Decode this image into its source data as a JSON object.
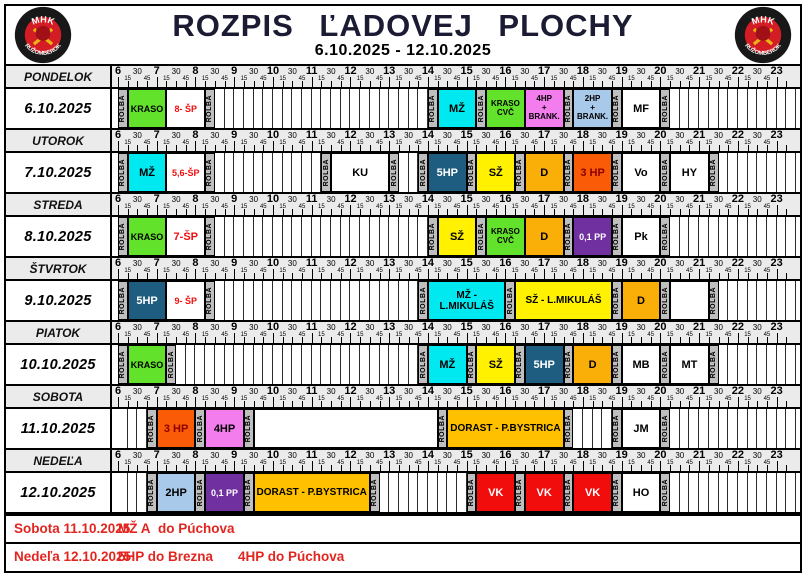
{
  "header": {
    "title": "ROZPIS ĽADOVEJ PLOCHY",
    "date_range": "6.10.2025 - 12.10.2025",
    "logo_top": "MHK",
    "logo_bottom": "RUŽOMBEROK"
  },
  "timeline": {
    "start": "6:00",
    "end": "23:30",
    "hours": [
      6,
      7,
      8,
      9,
      10,
      11,
      12,
      13,
      14,
      15,
      16,
      17,
      18,
      19,
      20,
      21,
      22,
      23
    ],
    "minute_labels": [
      "15",
      "30",
      "45"
    ]
  },
  "colors": {
    "rolba_bg": "#BFBFBF",
    "scale_bg": "#EBEBEB",
    "kraso_green": "#62E22B",
    "cyan": "#00E9F0",
    "yellow": "#FFF100",
    "dark_blue": "#1E5C80",
    "orange": "#FAAE08",
    "amber": "#FFC000",
    "orange_red": "#F95B06",
    "pink": "#F47DEE",
    "light_blue": "#A9C9EA",
    "purple": "#7030A0",
    "red": "#F20D0D",
    "sp_text_red": "#F10E0E",
    "dark_red_text": "#8B0000",
    "footer_red": "#E2251F",
    "title_color": "#1B1B33"
  },
  "days": [
    {
      "name": "PONDELOK",
      "date": "6.10.2025",
      "blocks": [
        {
          "s": "6:00",
          "e": "6:15",
          "l": "ROLBA",
          "t": "rolba"
        },
        {
          "s": "6:15",
          "e": "7:15",
          "l": "KRASO",
          "bg": "#62E22B",
          "fg": "#000000"
        },
        {
          "s": "7:15",
          "e": "8:15",
          "l": "8- ŠP",
          "bg": "#FFFFFF",
          "fg": "#F10E0E"
        },
        {
          "s": "8:15",
          "e": "8:30",
          "l": "ROLBA",
          "t": "rolba"
        },
        {
          "s": "14:00",
          "e": "14:15",
          "l": "ROLBA",
          "t": "rolba"
        },
        {
          "s": "14:15",
          "e": "15:15",
          "l": "MŽ",
          "bg": "#00E9F0",
          "fg": "#000000"
        },
        {
          "s": "15:15",
          "e": "15:30",
          "l": "ROLBA",
          "t": "rolba"
        },
        {
          "s": "15:30",
          "e": "16:30",
          "l": "KRASO\nCVČ",
          "bg": "#62E22B",
          "fg": "#000000"
        },
        {
          "s": "16:30",
          "e": "17:30",
          "l": "4HP\n+\nBRANK.",
          "bg": "#F47DEE",
          "fg": "#000000"
        },
        {
          "s": "17:30",
          "e": "17:45",
          "l": "ROLBA",
          "t": "rolba"
        },
        {
          "s": "17:45",
          "e": "18:45",
          "l": "2HP\n+ BRANK.",
          "bg": "#A9C9EA",
          "fg": "#000000"
        },
        {
          "s": "18:45",
          "e": "19:00",
          "l": "ROLBA",
          "t": "rolba"
        },
        {
          "s": "19:00",
          "e": "20:00",
          "l": "MF",
          "bg": "#FFFFFF",
          "fg": "#000000"
        },
        {
          "s": "20:00",
          "e": "20:15",
          "l": "ROLBA",
          "t": "rolba"
        }
      ]
    },
    {
      "name": "UTOROK",
      "date": "7.10.2025",
      "blocks": [
        {
          "s": "6:00",
          "e": "6:15",
          "l": "ROLBA",
          "t": "rolba"
        },
        {
          "s": "6:15",
          "e": "7:15",
          "l": "MŽ",
          "bg": "#00E9F0",
          "fg": "#000000"
        },
        {
          "s": "7:15",
          "e": "8:15",
          "l": "5,6-ŠP",
          "bg": "#FFFFFF",
          "fg": "#F10E0E"
        },
        {
          "s": "8:15",
          "e": "8:30",
          "l": "ROLBA",
          "t": "rolba"
        },
        {
          "s": "11:15",
          "e": "11:30",
          "l": "ROLBA",
          "t": "rolba"
        },
        {
          "s": "11:30",
          "e": "13:00",
          "l": "KU",
          "bg": "#FFFFFF",
          "fg": "#000000"
        },
        {
          "s": "13:00",
          "e": "13:15",
          "l": "ROLBA",
          "t": "rolba"
        },
        {
          "s": "13:45",
          "e": "14:00",
          "l": "ROLBA",
          "t": "rolba"
        },
        {
          "s": "14:00",
          "e": "15:00",
          "l": "5HP",
          "bg": "#1E5C80",
          "fg": "#FFFFFF"
        },
        {
          "s": "15:00",
          "e": "15:15",
          "l": "ROLBA",
          "t": "rolba"
        },
        {
          "s": "15:15",
          "e": "16:15",
          "l": "SŽ",
          "bg": "#FFF100",
          "fg": "#000000"
        },
        {
          "s": "16:15",
          "e": "16:30",
          "l": "ROLBA",
          "t": "rolba"
        },
        {
          "s": "16:30",
          "e": "17:30",
          "l": "D",
          "bg": "#FAAE08",
          "fg": "#000000"
        },
        {
          "s": "17:30",
          "e": "17:45",
          "l": "ROLBA",
          "t": "rolba"
        },
        {
          "s": "17:45",
          "e": "18:45",
          "l": "3 HP",
          "bg": "#F95B06",
          "fg": "#8B0000"
        },
        {
          "s": "18:45",
          "e": "19:00",
          "l": "ROLBA",
          "t": "rolba"
        },
        {
          "s": "19:00",
          "e": "20:00",
          "l": "Vo",
          "bg": "#FFFFFF",
          "fg": "#000000"
        },
        {
          "s": "20:00",
          "e": "20:15",
          "l": "ROLBA",
          "t": "rolba"
        },
        {
          "s": "20:15",
          "e": "21:15",
          "l": "HY",
          "bg": "#FFFFFF",
          "fg": "#000000"
        },
        {
          "s": "21:15",
          "e": "21:30",
          "l": "ROLBA",
          "t": "rolba"
        }
      ]
    },
    {
      "name": "STREDA",
      "date": "8.10.2025",
      "blocks": [
        {
          "s": "6:00",
          "e": "6:15",
          "l": "ROLBA",
          "t": "rolba"
        },
        {
          "s": "6:15",
          "e": "7:15",
          "l": "KRASO",
          "bg": "#62E22B",
          "fg": "#000000"
        },
        {
          "s": "7:15",
          "e": "8:15",
          "l": "7-ŠP",
          "bg": "#FFFFFF",
          "fg": "#F10E0E"
        },
        {
          "s": "8:15",
          "e": "8:30",
          "l": "ROLBA",
          "t": "rolba"
        },
        {
          "s": "14:00",
          "e": "14:15",
          "l": "ROLBA",
          "t": "rolba"
        },
        {
          "s": "14:15",
          "e": "15:15",
          "l": "SŽ",
          "bg": "#FFF100",
          "fg": "#000000"
        },
        {
          "s": "15:15",
          "e": "15:30",
          "l": "ROLBA",
          "t": "rolba"
        },
        {
          "s": "15:30",
          "e": "16:30",
          "l": "KRASO\nCVČ",
          "bg": "#62E22B",
          "fg": "#000000"
        },
        {
          "s": "16:30",
          "e": "17:30",
          "l": "D",
          "bg": "#FAAE08",
          "fg": "#000000"
        },
        {
          "s": "17:30",
          "e": "17:45",
          "l": "ROLBA",
          "t": "rolba"
        },
        {
          "s": "17:45",
          "e": "18:45",
          "l": "0,1 PP",
          "bg": "#7030A0",
          "fg": "#FFFFFF"
        },
        {
          "s": "18:45",
          "e": "19:00",
          "l": "ROLBA",
          "t": "rolba"
        },
        {
          "s": "19:00",
          "e": "20:00",
          "l": "Pk",
          "bg": "#FFFFFF",
          "fg": "#000000"
        },
        {
          "s": "20:00",
          "e": "20:15",
          "l": "ROLBA",
          "t": "rolba"
        }
      ]
    },
    {
      "name": "ŠTVRTOK",
      "date": "9.10.2025",
      "gaps": [
        {
          "s": "20:15",
          "e": "21:15"
        }
      ],
      "blocks": [
        {
          "s": "6:00",
          "e": "6:15",
          "l": "ROLBA",
          "t": "rolba"
        },
        {
          "s": "6:15",
          "e": "7:15",
          "l": "5HP",
          "bg": "#1E5C80",
          "fg": "#FFFFFF"
        },
        {
          "s": "7:15",
          "e": "8:15",
          "l": "9- ŠP",
          "bg": "#FFFFFF",
          "fg": "#F10E0E"
        },
        {
          "s": "8:15",
          "e": "8:30",
          "l": "ROLBA",
          "t": "rolba"
        },
        {
          "s": "13:45",
          "e": "14:00",
          "l": "ROLBA",
          "t": "rolba"
        },
        {
          "s": "14:00",
          "e": "16:00",
          "l": "MŽ - L.MIKULÁŠ",
          "bg": "#00E9F0",
          "fg": "#000000"
        },
        {
          "s": "16:00",
          "e": "16:15",
          "l": "ROLBA",
          "t": "rolba"
        },
        {
          "s": "16:15",
          "e": "18:45",
          "l": "SŽ - L.MIKULÁŠ",
          "bg": "#FFF100",
          "fg": "#000000"
        },
        {
          "s": "18:45",
          "e": "19:00",
          "l": "ROLBA",
          "t": "rolba"
        },
        {
          "s": "19:00",
          "e": "20:00",
          "l": "D",
          "bg": "#FAAE08",
          "fg": "#000000"
        },
        {
          "s": "20:00",
          "e": "20:15",
          "l": "ROLBA",
          "t": "rolba"
        },
        {
          "s": "21:15",
          "e": "21:30",
          "l": "ROLBA",
          "t": "rolba"
        }
      ]
    },
    {
      "name": "PIATOK",
      "date": "10.10.2025",
      "blocks": [
        {
          "s": "6:00",
          "e": "6:15",
          "l": "ROLBA",
          "t": "rolba"
        },
        {
          "s": "6:15",
          "e": "7:15",
          "l": "KRASO",
          "bg": "#62E22B",
          "fg": "#000000"
        },
        {
          "s": "7:15",
          "e": "7:30",
          "l": "ROLBA",
          "t": "rolba"
        },
        {
          "s": "13:45",
          "e": "14:00",
          "l": "ROLBA",
          "t": "rolba"
        },
        {
          "s": "14:00",
          "e": "15:00",
          "l": "MŽ",
          "bg": "#00E9F0",
          "fg": "#000000"
        },
        {
          "s": "15:00",
          "e": "15:15",
          "l": "ROLBA",
          "t": "rolba"
        },
        {
          "s": "15:15",
          "e": "16:15",
          "l": "SŽ",
          "bg": "#FFF100",
          "fg": "#000000"
        },
        {
          "s": "16:15",
          "e": "16:30",
          "l": "ROLBA",
          "t": "rolba"
        },
        {
          "s": "16:30",
          "e": "17:30",
          "l": "5HP",
          "bg": "#1E5C80",
          "fg": "#FFFFFF"
        },
        {
          "s": "17:30",
          "e": "17:45",
          "l": "ROLBA",
          "t": "rolba"
        },
        {
          "s": "17:45",
          "e": "18:45",
          "l": "D",
          "bg": "#FAAE08",
          "fg": "#000000"
        },
        {
          "s": "18:45",
          "e": "19:00",
          "l": "ROLBA",
          "t": "rolba"
        },
        {
          "s": "19:00",
          "e": "20:00",
          "l": "MB",
          "bg": "#FFFFFF",
          "fg": "#000000"
        },
        {
          "s": "20:00",
          "e": "20:15",
          "l": "ROLBA",
          "t": "rolba"
        },
        {
          "s": "20:15",
          "e": "21:15",
          "l": "MT",
          "bg": "#FFFFFF",
          "fg": "#000000"
        },
        {
          "s": "21:15",
          "e": "21:30",
          "l": "ROLBA",
          "t": "rolba"
        }
      ]
    },
    {
      "name": "SOBOTA",
      "date": "11.10.2025",
      "gaps": [
        {
          "s": "9:30",
          "e": "14:15"
        }
      ],
      "blocks": [
        {
          "s": "6:45",
          "e": "7:00",
          "l": "ROLBA",
          "t": "rolba"
        },
        {
          "s": "7:00",
          "e": "8:00",
          "l": "3 HP",
          "bg": "#F95B06",
          "fg": "#8B0000"
        },
        {
          "s": "8:00",
          "e": "8:15",
          "l": "ROLBA",
          "t": "rolba"
        },
        {
          "s": "8:15",
          "e": "9:15",
          "l": "4HP",
          "bg": "#F47DEE",
          "fg": "#000000"
        },
        {
          "s": "9:15",
          "e": "9:30",
          "l": "ROLBA",
          "t": "rolba"
        },
        {
          "s": "14:15",
          "e": "14:30",
          "l": "ROLBA",
          "t": "rolba"
        },
        {
          "s": "14:30",
          "e": "17:30",
          "l": "DORAST - P.BYSTRICA",
          "bg": "#FFC000",
          "fg": "#000000"
        },
        {
          "s": "17:30",
          "e": "17:45",
          "l": "ROLBA",
          "t": "rolba"
        },
        {
          "s": "18:45",
          "e": "19:00",
          "l": "ROLBA",
          "t": "rolba"
        },
        {
          "s": "19:00",
          "e": "20:00",
          "l": "JM",
          "bg": "#FFFFFF",
          "fg": "#000000"
        },
        {
          "s": "20:00",
          "e": "20:15",
          "l": "ROLBA",
          "t": "rolba"
        }
      ]
    },
    {
      "name": "NEDEĽA",
      "date": "12.10.2025",
      "blocks": [
        {
          "s": "6:45",
          "e": "7:00",
          "l": "ROLBA",
          "t": "rolba"
        },
        {
          "s": "7:00",
          "e": "8:00",
          "l": "2HP",
          "bg": "#A9C9EA",
          "fg": "#000000"
        },
        {
          "s": "8:00",
          "e": "8:15",
          "l": "ROLBA",
          "t": "rolba"
        },
        {
          "s": "8:15",
          "e": "9:15",
          "l": "0,1 PP",
          "bg": "#7030A0",
          "fg": "#FFFFFF"
        },
        {
          "s": "9:15",
          "e": "9:30",
          "l": "ROLBA",
          "t": "rolba"
        },
        {
          "s": "9:30",
          "e": "12:30",
          "l": "DORAST - P.BYSTRICA",
          "bg": "#FFC000",
          "fg": "#000000"
        },
        {
          "s": "12:30",
          "e": "12:45",
          "l": "ROLBA",
          "t": "rolba"
        },
        {
          "s": "15:00",
          "e": "15:15",
          "l": "ROLBA",
          "t": "rolba"
        },
        {
          "s": "15:15",
          "e": "16:15",
          "l": "VK",
          "bg": "#F20D0D",
          "fg": "#FFFFFF"
        },
        {
          "s": "16:15",
          "e": "16:30",
          "l": "ROLBA",
          "t": "rolba"
        },
        {
          "s": "16:30",
          "e": "17:30",
          "l": "VK",
          "bg": "#F20D0D",
          "fg": "#FFFFFF"
        },
        {
          "s": "17:30",
          "e": "17:45",
          "l": "ROLBA",
          "t": "rolba"
        },
        {
          "s": "17:45",
          "e": "18:45",
          "l": "VK",
          "bg": "#F20D0D",
          "fg": "#FFFFFF"
        },
        {
          "s": "18:45",
          "e": "19:00",
          "l": "ROLBA",
          "t": "rolba"
        },
        {
          "s": "19:00",
          "e": "20:00",
          "l": "HO",
          "bg": "#FFFFFF",
          "fg": "#000000"
        },
        {
          "s": "20:00",
          "e": "20:15",
          "l": "ROLBA",
          "t": "rolba"
        }
      ]
    }
  ],
  "footer": {
    "notes": [
      {
        "parts": [
          {
            "text": "Sobota 11.10.2025",
            "x": 8
          },
          {
            "text": "MŽ A",
            "x": 112
          },
          {
            "text": "do Púchova",
            "x": 152
          }
        ]
      },
      {
        "parts": [
          {
            "text": "Nedeľa 12.10.2025",
            "x": 8
          },
          {
            "text": "5HP do Brezna",
            "x": 112
          },
          {
            "text": "4HP do Púchova",
            "x": 232
          }
        ]
      }
    ]
  }
}
